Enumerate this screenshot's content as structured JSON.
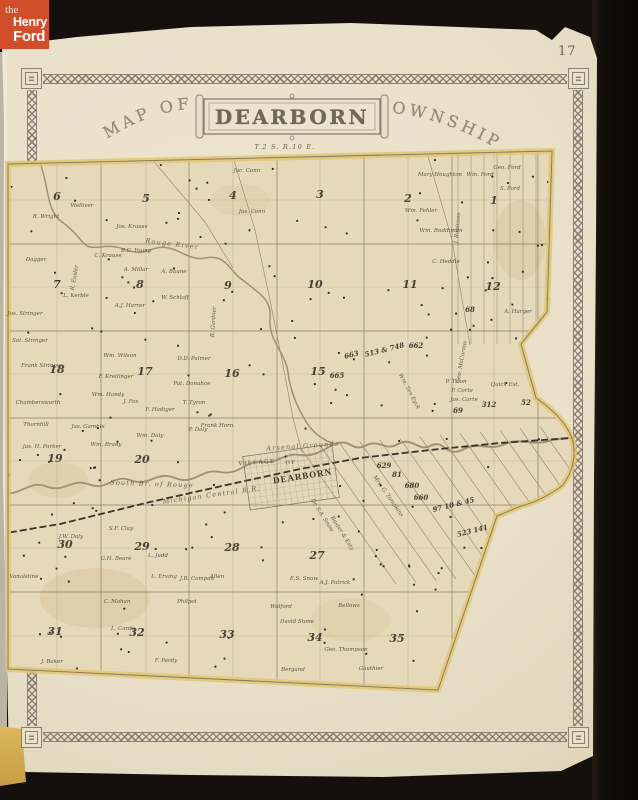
{
  "colors": {
    "logo_bg": "#d14e2b",
    "paper": "#e9e0ca",
    "map_paper": "#e6d9ba",
    "boundary_highlight": "#dfc671",
    "border_ink": "#8b8372",
    "map_ink": "#5f5444",
    "background": "#14100d"
  },
  "logo": {
    "the": "the",
    "henry": "Henry",
    "ford": "Ford"
  },
  "page_number": "17",
  "title": {
    "prefix": "MAP OF",
    "name": "DEARBORN",
    "suffix": "TOWNSHIP"
  },
  "map": {
    "labels": [
      {
        "t": "T.2 S. R.10 E.",
        "x": 285,
        "y": 149,
        "c": "feat"
      },
      {
        "t": "Arsenal Grounds",
        "x": 303,
        "y": 448,
        "r": -4,
        "c": "feat"
      },
      {
        "t": "Rouge River",
        "x": 172,
        "y": 246,
        "r": 7,
        "c": "feat"
      },
      {
        "t": "South Br. of Rouge",
        "x": 152,
        "y": 486,
        "r": 2,
        "c": "feat"
      },
      {
        "t": "Michigan Central R.R.",
        "x": 212,
        "y": 497,
        "r": -8,
        "c": "feat"
      },
      {
        "t": "VILLAGE",
        "x": 257,
        "y": 464,
        "r": -4,
        "c": "vils"
      },
      {
        "t": "OF",
        "x": 291,
        "y": 464,
        "r": -4,
        "c": "vils"
      },
      {
        "t": "DEARBORN",
        "x": 303,
        "y": 479,
        "r": -9,
        "c": "vilb"
      },
      {
        "t": "6",
        "x": 57,
        "y": 200,
        "c": "sec"
      },
      {
        "t": "5",
        "x": 146,
        "y": 202,
        "c": "sec"
      },
      {
        "t": "4",
        "x": 233,
        "y": 199,
        "c": "sec"
      },
      {
        "t": "3",
        "x": 320,
        "y": 198,
        "c": "sec"
      },
      {
        "t": "2",
        "x": 408,
        "y": 202,
        "c": "sec"
      },
      {
        "t": "1",
        "x": 494,
        "y": 204,
        "c": "sec"
      },
      {
        "t": "7",
        "x": 57,
        "y": 288,
        "c": "sec"
      },
      {
        "t": "8",
        "x": 140,
        "y": 288,
        "c": "sec"
      },
      {
        "t": "9",
        "x": 228,
        "y": 289,
        "c": "sec"
      },
      {
        "t": "10",
        "x": 315,
        "y": 288,
        "c": "sec"
      },
      {
        "t": "11",
        "x": 410,
        "y": 288,
        "c": "sec"
      },
      {
        "t": "12",
        "x": 493,
        "y": 290,
        "c": "sec"
      },
      {
        "t": "18",
        "x": 57,
        "y": 373,
        "c": "sec"
      },
      {
        "t": "17",
        "x": 145,
        "y": 375,
        "c": "sec"
      },
      {
        "t": "16",
        "x": 232,
        "y": 377,
        "c": "sec"
      },
      {
        "t": "15",
        "x": 318,
        "y": 375,
        "c": "sec"
      },
      {
        "t": "19",
        "x": 55,
        "y": 462,
        "c": "sec"
      },
      {
        "t": "20",
        "x": 142,
        "y": 463,
        "c": "sec"
      },
      {
        "t": "30",
        "x": 65,
        "y": 548,
        "c": "sec"
      },
      {
        "t": "29",
        "x": 142,
        "y": 550,
        "c": "sec"
      },
      {
        "t": "28",
        "x": 232,
        "y": 551,
        "c": "sec"
      },
      {
        "t": "27",
        "x": 317,
        "y": 559,
        "c": "sec"
      },
      {
        "t": "31",
        "x": 55,
        "y": 635,
        "c": "sec"
      },
      {
        "t": "32",
        "x": 137,
        "y": 636,
        "c": "sec"
      },
      {
        "t": "33",
        "x": 227,
        "y": 638,
        "c": "sec"
      },
      {
        "t": "34",
        "x": 315,
        "y": 641,
        "c": "sec"
      },
      {
        "t": "35",
        "x": 397,
        "y": 642,
        "c": "sec"
      },
      {
        "t": "663",
        "x": 352,
        "y": 357,
        "r": -14,
        "c": "num"
      },
      {
        "t": "513 & 748",
        "x": 385,
        "y": 352,
        "r": -14,
        "c": "num"
      },
      {
        "t": "662",
        "x": 416,
        "y": 348,
        "c": "num"
      },
      {
        "t": "665",
        "x": 337,
        "y": 378,
        "c": "num"
      },
      {
        "t": "68",
        "x": 470,
        "y": 312,
        "c": "num"
      },
      {
        "t": "69",
        "x": 458,
        "y": 413,
        "c": "num"
      },
      {
        "t": "312",
        "x": 489,
        "y": 407,
        "c": "num"
      },
      {
        "t": "52",
        "x": 526,
        "y": 405,
        "c": "num"
      },
      {
        "t": "629",
        "x": 384,
        "y": 468,
        "c": "num"
      },
      {
        "t": "81",
        "x": 397,
        "y": 477,
        "c": "num"
      },
      {
        "t": "680",
        "x": 412,
        "y": 488,
        "c": "num"
      },
      {
        "t": "660",
        "x": 421,
        "y": 500,
        "c": "num"
      },
      {
        "t": "97 10 & 45",
        "x": 454,
        "y": 507,
        "r": -14,
        "c": "num"
      },
      {
        "t": "523 141",
        "x": 473,
        "y": 533,
        "r": -14,
        "c": "num"
      },
      {
        "t": "Jos. Stringer",
        "x": 25,
        "y": 315,
        "c": "own"
      },
      {
        "t": "Sol. Stringer",
        "x": 30,
        "y": 342,
        "c": "own"
      },
      {
        "t": "Frank Stringer",
        "x": 42,
        "y": 367,
        "c": "own"
      },
      {
        "t": "Chambersworth",
        "x": 38,
        "y": 404,
        "c": "own"
      },
      {
        "t": "Thornhill",
        "x": 36,
        "y": 426,
        "c": "own"
      },
      {
        "t": "Jas. H. Parker",
        "x": 42,
        "y": 448,
        "c": "own"
      },
      {
        "t": "Vanalstine",
        "x": 24,
        "y": 578,
        "c": "own"
      },
      {
        "t": "J. Baker",
        "x": 52,
        "y": 663,
        "c": "own"
      },
      {
        "t": "R. Wright",
        "x": 46,
        "y": 218,
        "c": "own"
      },
      {
        "t": "Welliver",
        "x": 82,
        "y": 207,
        "c": "own"
      },
      {
        "t": "Jos. Krause",
        "x": 132,
        "y": 228,
        "c": "own"
      },
      {
        "t": "C. Krause",
        "x": 108,
        "y": 257,
        "c": "own"
      },
      {
        "t": "B.C. Young",
        "x": 136,
        "y": 252,
        "c": "own"
      },
      {
        "t": "A. Millar",
        "x": 136,
        "y": 271,
        "c": "own"
      },
      {
        "t": "A. Baune",
        "x": 174,
        "y": 273,
        "c": "own"
      },
      {
        "t": "Dagger",
        "x": 36,
        "y": 261,
        "c": "own"
      },
      {
        "t": "R. Easler",
        "x": 76,
        "y": 278,
        "r": -80,
        "c": "own"
      },
      {
        "t": "L. Kerble",
        "x": 76,
        "y": 297,
        "c": "own"
      },
      {
        "t": "A.J. Harrer",
        "x": 130,
        "y": 307,
        "c": "own"
      },
      {
        "t": "W. Schloff",
        "x": 175,
        "y": 299,
        "c": "own"
      },
      {
        "t": "Wm. Wilson",
        "x": 120,
        "y": 357,
        "c": "own"
      },
      {
        "t": "D.D. Palmer",
        "x": 194,
        "y": 360,
        "c": "own"
      },
      {
        "t": "F. Kreilinger",
        "x": 116,
        "y": 378,
        "c": "own"
      },
      {
        "t": "Pat. Donahoe",
        "x": 192,
        "y": 385,
        "c": "own"
      },
      {
        "t": "Wm. Handy",
        "x": 108,
        "y": 396,
        "c": "own"
      },
      {
        "t": "J. Fox",
        "x": 131,
        "y": 403,
        "c": "own"
      },
      {
        "t": "F. Hadiger",
        "x": 160,
        "y": 411,
        "c": "own"
      },
      {
        "t": "T. Tyron",
        "x": 194,
        "y": 404,
        "c": "own"
      },
      {
        "t": "Wm. Daly",
        "x": 150,
        "y": 437,
        "c": "own"
      },
      {
        "t": "P. Daly",
        "x": 198,
        "y": 431,
        "c": "own"
      },
      {
        "t": "Frank Horn",
        "x": 217,
        "y": 427,
        "c": "own"
      },
      {
        "t": "Wm. Brady",
        "x": 106,
        "y": 446,
        "c": "own"
      },
      {
        "t": "Jas. Gamble",
        "x": 88,
        "y": 428,
        "c": "own"
      },
      {
        "t": "R. Gardner",
        "x": 215,
        "y": 322,
        "r": -86,
        "c": "own"
      },
      {
        "t": "Jac. Conn",
        "x": 247,
        "y": 172,
        "c": "own"
      },
      {
        "t": "Jos. Conn",
        "x": 252,
        "y": 213,
        "c": "own"
      },
      {
        "t": "Mary Houghton",
        "x": 440,
        "y": 176,
        "c": "own"
      },
      {
        "t": "Wm. Ford",
        "x": 480,
        "y": 176,
        "c": "own"
      },
      {
        "t": "Geo. Ford",
        "x": 507,
        "y": 169,
        "c": "own"
      },
      {
        "t": "S. Ford",
        "x": 510,
        "y": 190,
        "c": "own"
      },
      {
        "t": "Wm. Fehler",
        "x": 421,
        "y": 212,
        "c": "own"
      },
      {
        "t": "Wm. Ruddiman",
        "x": 441,
        "y": 232,
        "c": "own"
      },
      {
        "t": "C. Heddle",
        "x": 446,
        "y": 263,
        "c": "own"
      },
      {
        "t": "J. Robinson",
        "x": 459,
        "y": 228,
        "r": -85,
        "c": "own"
      },
      {
        "t": "A. Harger",
        "x": 518,
        "y": 313,
        "c": "own"
      },
      {
        "t": "Geo. McCormic",
        "x": 463,
        "y": 362,
        "r": -80,
        "c": "own"
      },
      {
        "t": "P. Tiron",
        "x": 456,
        "y": 383,
        "c": "own"
      },
      {
        "t": "P. Corte",
        "x": 462,
        "y": 392,
        "c": "own"
      },
      {
        "t": "Jos. Corte",
        "x": 464,
        "y": 401,
        "c": "own"
      },
      {
        "t": "Quick Est.",
        "x": 505,
        "y": 386,
        "c": "own"
      },
      {
        "t": "Wm. Ten Eyck",
        "x": 408,
        "y": 392,
        "r": 62,
        "c": "own"
      },
      {
        "t": "S.F. Clay",
        "x": 121,
        "y": 530,
        "c": "own"
      },
      {
        "t": "J.W. Daly",
        "x": 71,
        "y": 538,
        "c": "own"
      },
      {
        "t": "G.H. Beare",
        "x": 116,
        "y": 560,
        "c": "own"
      },
      {
        "t": "L. Judd",
        "x": 158,
        "y": 557,
        "c": "own"
      },
      {
        "t": "L. Erving",
        "x": 164,
        "y": 578,
        "c": "own"
      },
      {
        "t": "J.B. Compau",
        "x": 197,
        "y": 580,
        "c": "own"
      },
      {
        "t": "Allen",
        "x": 217,
        "y": 578,
        "c": "own"
      },
      {
        "t": "C. Mahan",
        "x": 117,
        "y": 603,
        "c": "own"
      },
      {
        "t": "L. Carde",
        "x": 123,
        "y": 630,
        "c": "own"
      },
      {
        "t": "Philpot",
        "x": 187,
        "y": 603,
        "c": "own"
      },
      {
        "t": "F. Pardy",
        "x": 166,
        "y": 662,
        "c": "own"
      },
      {
        "t": "Dr. S.A. Snow",
        "x": 321,
        "y": 516,
        "r": 58,
        "c": "own"
      },
      {
        "t": "Mrs. G. Tompkins",
        "x": 387,
        "y": 497,
        "r": 55,
        "c": "own"
      },
      {
        "t": "Baxter & Esty",
        "x": 341,
        "y": 534,
        "r": 58,
        "c": "own"
      },
      {
        "t": "E.S. Snow",
        "x": 304,
        "y": 580,
        "c": "own"
      },
      {
        "t": "A.J. Patrick",
        "x": 335,
        "y": 584,
        "c": "own"
      },
      {
        "t": "Wolford",
        "x": 281,
        "y": 608,
        "c": "own"
      },
      {
        "t": "David Stone",
        "x": 297,
        "y": 623,
        "c": "own"
      },
      {
        "t": "Bellows",
        "x": 349,
        "y": 607,
        "c": "own"
      },
      {
        "t": "Geo. Thompson",
        "x": 346,
        "y": 651,
        "c": "own"
      },
      {
        "t": "Bergand",
        "x": 293,
        "y": 671,
        "c": "own"
      },
      {
        "t": "Gauthier",
        "x": 371,
        "y": 670,
        "c": "own"
      }
    ]
  }
}
